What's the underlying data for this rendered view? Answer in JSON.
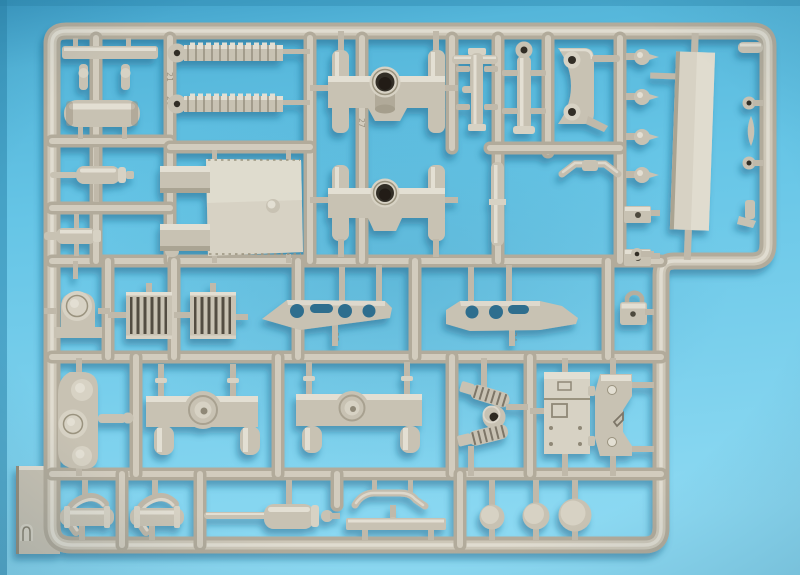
{
  "meta": {
    "description": "Photograph of a light-tan injection-molded plastic model kit sprue (parts tree) lying on a cyan-blue paper background, lit from the upper right with soft blue shadows cast below-left of the plastic runners and parts"
  },
  "scene": {
    "background": {
      "color_top": "#3e9dc6",
      "color_main": "#66c5e6",
      "color_bottom": "#8cd9f2",
      "shadow_color": "#15597c"
    },
    "sprue": {
      "material": "styrene plastic",
      "plastic_base_color": "#b2ab9b",
      "plastic_mid_color": "#c8c2b3",
      "plastic_highlight_color": "#e3dfd3",
      "hole_color": "#332f28",
      "frame_shape": "rounded rectangle with cut-away lower-right notch",
      "embossed_numbers": [
        "21",
        "20",
        "27",
        "23",
        "24"
      ],
      "parts": [
        {
          "id": "flat-strip",
          "label": "thin flat strip"
        },
        {
          "id": "stud-pair",
          "label": "two small studs"
        },
        {
          "id": "muffler-cylinder",
          "label": "large cylinder / muffler"
        },
        {
          "id": "recoil-cylinder-upper",
          "label": "cylinder with piston rod"
        },
        {
          "id": "small-cylinder",
          "label": "small cylinder with nozzle"
        },
        {
          "id": "small-post",
          "label": "small ribbed post"
        },
        {
          "id": "track-pad-1",
          "label": "ribbed tread strip with round boss"
        },
        {
          "id": "track-pad-2",
          "label": "ribbed tread strip with round boss"
        },
        {
          "id": "gun-shield",
          "label": "large square shield plate with two hinge blocks"
        },
        {
          "id": "gun-cradle-upper",
          "label": "gun cradle with barrel collar and four trunnion cylinders"
        },
        {
          "id": "gun-cradle-lower",
          "label": "gun cradle with barrel collar and four trunnion cylinders"
        },
        {
          "id": "t-rod",
          "label": "small T-shaped rod"
        },
        {
          "id": "flanged-cylinder",
          "label": "cylinder with flanged ends"
        },
        {
          "id": "eyelet-cylinder",
          "label": "cylinder with eyelet top"
        },
        {
          "id": "c-bracket",
          "label": "C-bracket with two eyelet lugs"
        },
        {
          "id": "linkage-rod",
          "label": "linkage rod with angled arms"
        },
        {
          "id": "thin-rod",
          "label": "long thin rod"
        },
        {
          "id": "ball-studs",
          "label": "four ball-stud tow hooks"
        },
        {
          "id": "box-fittings",
          "label": "two small box fittings"
        },
        {
          "id": "side-panel",
          "label": "long flat side panel"
        },
        {
          "id": "edge-fittings",
          "label": "small hooks and clasps on right rail"
        },
        {
          "id": "hook-fitting",
          "label": "hook fitting"
        },
        {
          "id": "padlock-bracket",
          "label": "padlock-shaped bracket"
        },
        {
          "id": "mount-bracket",
          "label": "rounded mount bracket"
        },
        {
          "id": "radiator-grille-1",
          "label": "slatted grille panel"
        },
        {
          "id": "radiator-grille-2",
          "label": "slatted grille panel"
        },
        {
          "id": "fender-left",
          "label": "angled fender plate with lightening holes"
        },
        {
          "id": "fender-right",
          "label": "angled fender plate with lightening holes"
        },
        {
          "id": "wheel-bogie",
          "label": "bogie plate with three round wheels"
        },
        {
          "id": "axle-beam-1",
          "label": "axle beam with round drum and two hanging cylinders"
        },
        {
          "id": "axle-beam-2",
          "label": "axle beam with round drum and two hanging cylinders"
        },
        {
          "id": "coil-springs",
          "label": "two coil springs with donut hub"
        },
        {
          "id": "stowage-box",
          "label": "stowage box with hatch detail"
        },
        {
          "id": "bracket-plate",
          "label": "waisted bracket plate with rivets"
        },
        {
          "id": "pipe-clamp-1",
          "label": "cylinder with U-pipe"
        },
        {
          "id": "pipe-clamp-2",
          "label": "cylinder with U-pipe"
        },
        {
          "id": "piston-assembly",
          "label": "recoil cylinder with long piston rod"
        },
        {
          "id": "bent-linkage",
          "label": "bent linkage rod"
        },
        {
          "id": "flat-bar",
          "label": "flat mounting bar"
        },
        {
          "id": "road-wheel-small",
          "label": "small round disc wheel"
        },
        {
          "id": "road-wheel-medium",
          "label": "medium round disc wheel"
        },
        {
          "id": "road-wheel-large",
          "label": "large round disc wheel"
        },
        {
          "id": "mold-tab",
          "label": "small D-shaped mold tab on frame"
        }
      ]
    }
  }
}
